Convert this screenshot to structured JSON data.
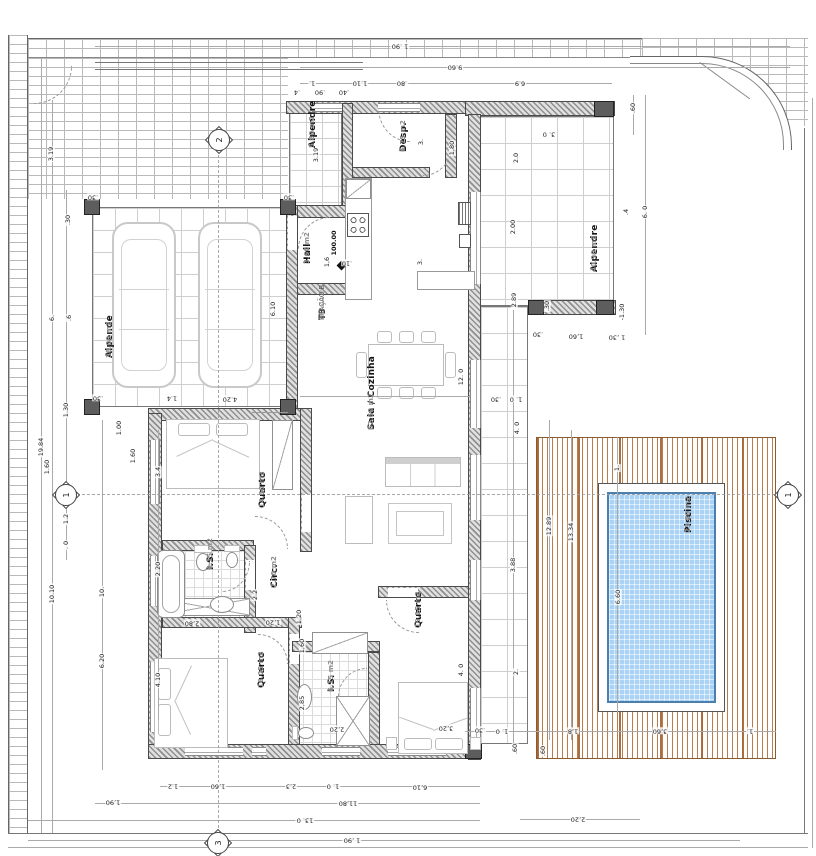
{
  "unit": {
    "l1": "T3",
    "l2": "FRAÇÃO B",
    "l3": "247.40 m2"
  },
  "level_marker": {
    "text": "100.00"
  },
  "colors": {
    "wall_hatch": "#8f8f8f",
    "deck_wood": "#ab652e",
    "pool_water": "#a9d2f5",
    "pool_border": "#4a7fae",
    "tile_line": "#cfcfcf",
    "brick_line": "#b9b9b9"
  },
  "rooms": [
    {
      "name": "Alpende",
      "area": "38.00 m2",
      "x": 105,
      "y": 358
    },
    {
      "name": "Alpendre",
      "area": "5.80 m2",
      "x": 308,
      "y": 148
    },
    {
      "name": "Desp.",
      "area": "6.75 m2",
      "x": 399,
      "y": 152
    },
    {
      "name": "Hall",
      "area": "3.60 m2",
      "x": 303,
      "y": 264
    },
    {
      "name": "Sala / Cozinha",
      "area": "62.60 m2",
      "x": 367,
      "y": 430
    },
    {
      "name": "Quarto",
      "area": "14.60 m2",
      "x": 258,
      "y": 508
    },
    {
      "name": "I.S.",
      "area": "6.15 m2",
      "x": 206,
      "y": 570
    },
    {
      "name": "Circ.",
      "area": "2.70 m2",
      "x": 270,
      "y": 588
    },
    {
      "name": "Quarto",
      "area": "16.05 m2",
      "x": 257,
      "y": 688
    },
    {
      "name": "I.S.",
      "area": "6,15 m2",
      "x": 327,
      "y": 692
    },
    {
      "name": "Quarto",
      "area": "19.15 m2",
      "x": 414,
      "y": 628
    },
    {
      "name": "Alpendre",
      "area": "40.90 m2",
      "x": 590,
      "y": 272
    },
    {
      "name": "Piscina",
      "area": "23.80 m2",
      "x": 684,
      "y": 533
    }
  ],
  "markers": [
    {
      "n": "2",
      "x": 219,
      "y": 140
    },
    {
      "n": "1",
      "x": 66,
      "y": 495
    },
    {
      "n": "1",
      "x": 788,
      "y": 495
    },
    {
      "n": "3",
      "x": 218,
      "y": 843
    }
  ],
  "dims": [
    {
      "t": "1 .90",
      "x": 400,
      "y": 46,
      "r": "u"
    },
    {
      "t": "9.60",
      "x": 455,
      "y": 67,
      "r": "u"
    },
    {
      "t": "1.",
      "x": 312,
      "y": 83,
      "r": "u"
    },
    {
      "t": "1.10",
      "x": 360,
      "y": 83,
      "r": "u"
    },
    {
      "t": ".80",
      "x": 402,
      "y": 83,
      "r": "u"
    },
    {
      "t": "6.9",
      "x": 520,
      "y": 83,
      "r": "u"
    },
    {
      "t": ".4",
      "x": 297,
      "y": 92,
      "r": "u"
    },
    {
      "t": ".90",
      "x": 320,
      "y": 92,
      "r": "u"
    },
    {
      "t": ".40",
      "x": 344,
      "y": 92,
      "r": "u"
    },
    {
      "t": ".60",
      "x": 633,
      "y": 108,
      "r": "v"
    },
    {
      "t": "3. 0",
      "x": 549,
      "y": 134,
      "r": "u"
    },
    {
      "t": "2.0",
      "x": 516,
      "y": 158,
      "r": "v"
    },
    {
      "t": "2.00",
      "x": 513,
      "y": 227,
      "r": "v"
    },
    {
      "t": "6. 0",
      "x": 645,
      "y": 212,
      "r": "v"
    },
    {
      "t": ".4",
      "x": 626,
      "y": 212,
      "r": "v"
    },
    {
      "t": "2.89",
      "x": 514,
      "y": 300,
      "r": "v"
    },
    {
      "t": ".30",
      "x": 547,
      "y": 306,
      "r": "v"
    },
    {
      "t": "-1.30",
      "x": 622,
      "y": 312,
      "r": "v"
    },
    {
      "t": "1 ,30",
      "x": 617,
      "y": 337,
      "r": "u"
    },
    {
      "t": "1,60",
      "x": 576,
      "y": 336,
      "r": "u"
    },
    {
      "t": ".30",
      "x": 538,
      "y": 334,
      "r": "u"
    },
    {
      "t": "3.19",
      "x": 51,
      "y": 154,
      "r": "v"
    },
    {
      "t": ".30",
      "x": 68,
      "y": 220,
      "r": "v"
    },
    {
      "t": "6.",
      "x": 52,
      "y": 318,
      "r": "v"
    },
    {
      "t": ".6",
      "x": 69,
      "y": 318,
      "r": "v"
    },
    {
      "t": "1.30",
      "x": 66,
      "y": 410,
      "r": "v"
    },
    {
      "t": "19.84",
      "x": 41,
      "y": 447,
      "r": "v"
    },
    {
      "t": "1.60",
      "x": 47,
      "y": 467,
      "r": "v"
    },
    {
      "t": "1.2",
      "x": 66,
      "y": 519,
      "r": "v"
    },
    {
      "t": ". 0",
      "x": 66,
      "y": 545,
      "r": "v"
    },
    {
      "t": "10.10",
      "x": 52,
      "y": 594,
      "r": "v"
    },
    {
      "t": "10.",
      "x": 102,
      "y": 592,
      "r": "v"
    },
    {
      "t": "6.20",
      "x": 102,
      "y": 661,
      "r": "v"
    },
    {
      "t": "4.10",
      "x": 158,
      "y": 680,
      "r": "v"
    },
    {
      "t": "3.4",
      "x": 158,
      "y": 472,
      "r": "v"
    },
    {
      "t": "1.00",
      "x": 119,
      "y": 428,
      "r": "v"
    },
    {
      "t": "1.60",
      "x": 133,
      "y": 456,
      "r": "v"
    },
    {
      "t": ".30",
      "x": 93,
      "y": 197,
      "r": "u"
    },
    {
      "t": ".30",
      "x": 289,
      "y": 197,
      "r": "u"
    },
    {
      "t": "6.10",
      "x": 273,
      "y": 309,
      "r": "v"
    },
    {
      "t": "1.4",
      "x": 172,
      "y": 398,
      "r": "u"
    },
    {
      "t": "4.20",
      "x": 230,
      "y": 399,
      "r": "u"
    },
    {
      "t": ".30",
      "x": 98,
      "y": 398,
      "r": "u"
    },
    {
      "t": "3.19",
      "x": 316,
      "y": 155,
      "r": "v"
    },
    {
      "t": "1,80",
      "x": 452,
      "y": 148,
      "r": "v"
    },
    {
      "t": "3.",
      "x": 421,
      "y": 142,
      "r": "v"
    },
    {
      "t": "1,6",
      "x": 327,
      "y": 262,
      "r": "v"
    },
    {
      "t": ".10",
      "x": 347,
      "y": 263,
      "r": "u"
    },
    {
      "t": "3.",
      "x": 420,
      "y": 262,
      "r": "v"
    },
    {
      "t": "12. 0",
      "x": 461,
      "y": 377,
      "r": "v"
    },
    {
      "t": ".30",
      "x": 496,
      "y": 399,
      "r": "u"
    },
    {
      "t": "1. 0",
      "x": 516,
      "y": 399,
      "r": "u"
    },
    {
      "t": "4. 0",
      "x": 517,
      "y": 428,
      "r": "v"
    },
    {
      "t": "3.88",
      "x": 513,
      "y": 565,
      "r": "v"
    },
    {
      "t": "2.",
      "x": 516,
      "y": 672,
      "r": "v"
    },
    {
      "t": "12.89",
      "x": 549,
      "y": 526,
      "r": "v"
    },
    {
      "t": "13.34",
      "x": 571,
      "y": 532,
      "r": "v"
    },
    {
      "t": "1.",
      "x": 617,
      "y": 468,
      "r": "v"
    },
    {
      "t": "6.60",
      "x": 618,
      "y": 597,
      "r": "v"
    },
    {
      "t": "4. 0",
      "x": 461,
      "y": 670,
      "r": "v"
    },
    {
      "t": "3,20",
      "x": 446,
      "y": 728,
      "r": "u"
    },
    {
      "t": "2.2",
      "x": 255,
      "y": 595,
      "r": "v"
    },
    {
      "t": "2.20",
      "x": 158,
      "y": 569,
      "r": "v"
    },
    {
      "t": "2,80",
      "x": 192,
      "y": 623,
      "r": "u"
    },
    {
      "t": "1,20",
      "x": 273,
      "y": 622,
      "r": "u"
    },
    {
      "t": "1.20",
      "x": 299,
      "y": 617,
      "r": "v"
    },
    {
      "t": "1,60",
      "x": 302,
      "y": 646,
      "r": "v"
    },
    {
      "t": "2,20",
      "x": 337,
      "y": 729,
      "r": "u"
    },
    {
      "t": "2,85",
      "x": 302,
      "y": 703,
      "r": "v"
    },
    {
      "t": "1.2",
      "x": 173,
      "y": 786,
      "r": "u"
    },
    {
      "t": "1,60",
      "x": 218,
      "y": 786,
      "r": "u"
    },
    {
      "t": "2,3",
      "x": 291,
      "y": 786,
      "r": "u"
    },
    {
      "t": "1. 0",
      "x": 333,
      "y": 786,
      "r": "u"
    },
    {
      "t": "6,10",
      "x": 420,
      "y": 787,
      "r": "u"
    },
    {
      "t": "1,90",
      "x": 113,
      "y": 802,
      "r": "u"
    },
    {
      "t": "11,80",
      "x": 348,
      "y": 803,
      "r": "u"
    },
    {
      "t": "13. 0",
      "x": 305,
      "y": 820,
      "r": "u"
    },
    {
      "t": "1 ,90",
      "x": 352,
      "y": 840,
      "r": "u"
    },
    {
      "t": ".30",
      "x": 480,
      "y": 730,
      "r": "u"
    },
    {
      "t": "1. 0",
      "x": 502,
      "y": 731,
      "r": "u"
    },
    {
      "t": "1,8",
      "x": 573,
      "y": 731,
      "r": "u"
    },
    {
      "t": "3,60",
      "x": 660,
      "y": 731,
      "r": "u"
    },
    {
      "t": "1.",
      "x": 750,
      "y": 731,
      "r": "u"
    },
    {
      "t": ".60",
      "x": 515,
      "y": 749,
      "r": "v"
    },
    {
      "t": ".60",
      "x": 543,
      "y": 751,
      "r": "v"
    },
    {
      "t": "2,20",
      "x": 578,
      "y": 819,
      "r": "u"
    }
  ]
}
